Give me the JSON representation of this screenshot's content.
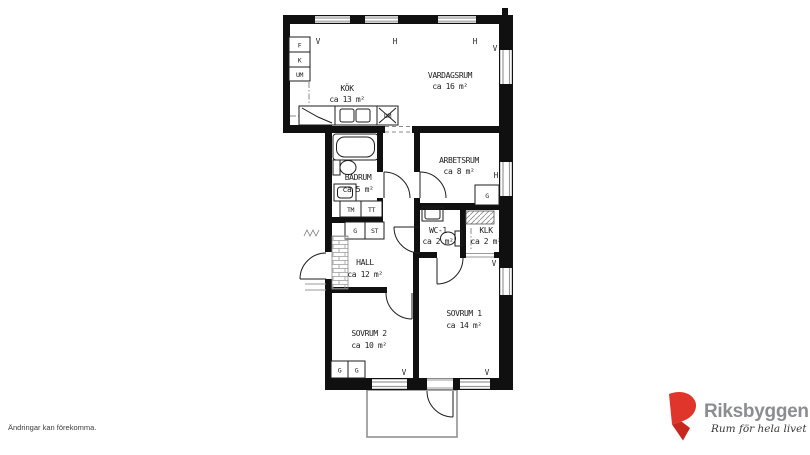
{
  "plan": {
    "rooms": [
      {
        "name": "KÖK",
        "area": "ca 13 m²"
      },
      {
        "name": "VARDAGSRUM",
        "area": "ca 16 m²"
      },
      {
        "name": "ARBETSRUM",
        "area": "ca 8 m²"
      },
      {
        "name": "BADRUM",
        "area": "ca 5 m²"
      },
      {
        "name": "WC-1",
        "area": "ca 2 m²"
      },
      {
        "name": "KLK",
        "area": "ca 2 m²"
      },
      {
        "name": "HALL",
        "area": "ca 12 m²"
      },
      {
        "name": "SOVRUM 2",
        "area": "ca 10 m²"
      },
      {
        "name": "SOVRUM 1",
        "area": "ca 14 m²"
      }
    ],
    "windows": [
      "V",
      "H",
      "H",
      "V",
      "H",
      "V",
      "V",
      "V"
    ],
    "fixtures": {
      "fridge": "F",
      "freezer": "K",
      "oven": "UM",
      "dishwasher": "DM",
      "washer": "TM",
      "dryer": "TT",
      "hall_g": "G",
      "hall_st": "ST",
      "arbetsrum_g": "G",
      "sovrum2_g1": "G",
      "sovrum2_g2": "G"
    },
    "wall_color": "#101010"
  },
  "footer": {
    "disclaimer": "Ändringar kan förekomma."
  },
  "logo": {
    "name": "Riksbyggen",
    "tagline": "Rum för hela livet",
    "brand_red": "#e0352b",
    "brand_gray": "#8b8d90"
  }
}
